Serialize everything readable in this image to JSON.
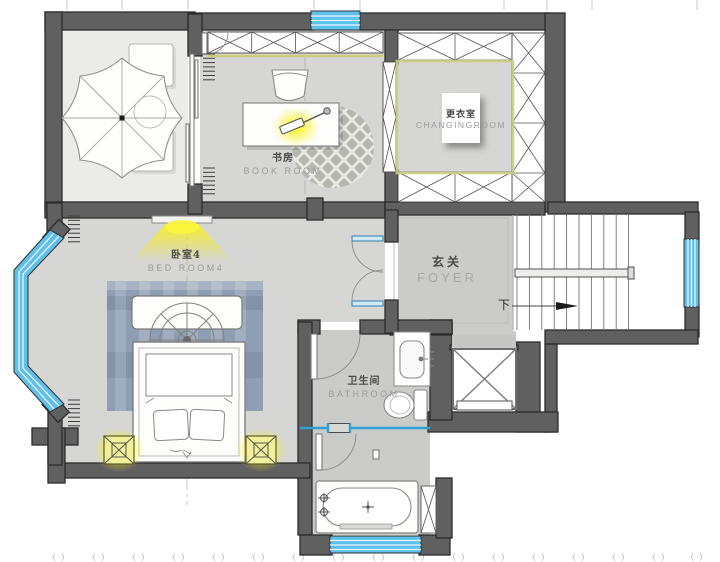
{
  "rooms": {
    "book_room": {
      "zh": "书房",
      "en": "BOOK ROOM"
    },
    "changing_room": {
      "zh": "更衣室",
      "en": "CHANGINGROOM"
    },
    "bedroom4": {
      "zh": "卧室4",
      "en": "BED ROOM4"
    },
    "foyer": {
      "zh": "玄关",
      "en": "FOYER"
    },
    "bathroom": {
      "zh": "卫生间",
      "en": "BATHROOM"
    }
  },
  "annotations": {
    "stairs_down": "下"
  },
  "colors": {
    "wall": "#606060",
    "wall_outline": "#2c2c2c",
    "floor": "#d6d6d4",
    "floor_dark": "#cbcbc9",
    "terrace_floor": "#ebebe7",
    "window_blue": "#5fc0ec",
    "wardrobe_accent": "#ccd07e",
    "glow_yellow": "#fbf403",
    "rug_blue": "#8f9fb3",
    "label_zh": "#4a4a4a",
    "label_en": "#9b9b9b"
  }
}
